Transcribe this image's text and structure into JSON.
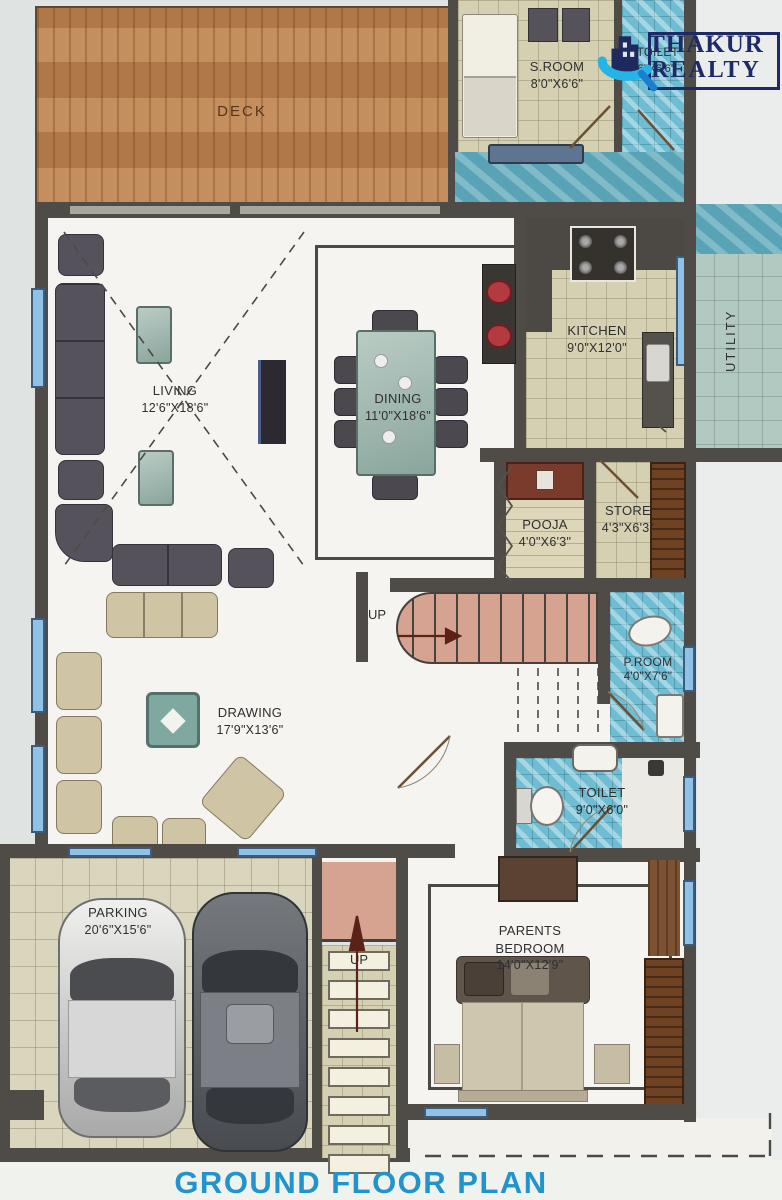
{
  "title": "GROUND FLOOR PLAN",
  "brand": {
    "name_line1": "THAKUR",
    "name_line2": "REALTY"
  },
  "rooms": {
    "deck": {
      "name": "DECK"
    },
    "s_room": {
      "name": "S.ROOM",
      "dims": "8'0\"X6'6\""
    },
    "s_toilet": {
      "name": "S.TOILET",
      "dims": "3'6\"X6'6\""
    },
    "kitchen": {
      "name": "KITCHEN",
      "dims": "9'0\"X12'0\""
    },
    "utility": {
      "name": "UTILITY"
    },
    "living": {
      "name": "LIVING",
      "dims": "12'6\"X18'6\""
    },
    "dining": {
      "name": "DINING",
      "dims": "11'0\"X18'6\""
    },
    "pooja": {
      "name": "POOJA",
      "dims": "4'0\"X6'3\""
    },
    "store": {
      "name": "STORE",
      "dims": "4'3\"X6'3\""
    },
    "p_room": {
      "name": "P.ROOM",
      "dims": "4'0\"X7'6\""
    },
    "drawing": {
      "name": "DRAWING",
      "dims": "17'9\"X13'6\""
    },
    "toilet": {
      "name": "TOILET",
      "dims": "9'0\"X6'0\""
    },
    "parking": {
      "name": "PARKING",
      "dims": "20'6\"X15'6\""
    },
    "parents_bedroom": {
      "name_line1": "PARENTS",
      "name_line2": "BEDROOM",
      "dims": "14'0\"X12'9\""
    }
  },
  "stairs": {
    "up_mid": "UP",
    "up_bottom": "UP"
  },
  "colors": {
    "wall": "#4f4b46",
    "floor": "#f5f4f0",
    "deck_wood": "#c08550",
    "tile_beige": "#d5d0b2",
    "tile_blue": "#6fbdd3",
    "utility_teal": "#b1c9c0",
    "stair_salmon": "#d7a391",
    "title_blue": "#2394cb",
    "logo_navy": "#1d2a66",
    "logo_cyan": "#24b4e8",
    "sofa_dark": "#55525c",
    "sofa_beige": "#cfc5a5",
    "table_teal": "#9dbdb5",
    "basin_red": "#b23a40"
  }
}
